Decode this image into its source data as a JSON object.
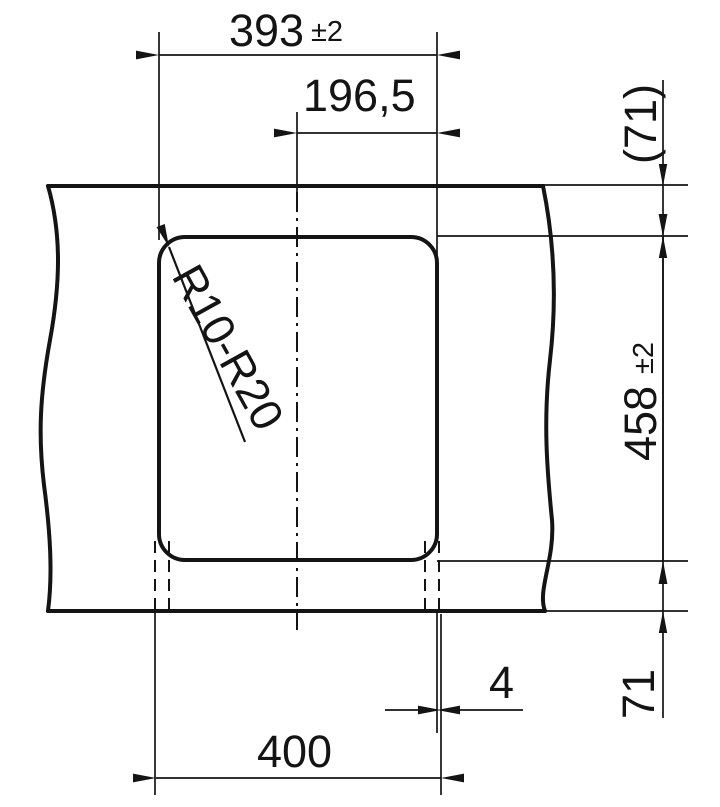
{
  "labels": {
    "cutout_width": "393",
    "cutout_width_tolerance": "±2",
    "centerline_offset": "196,5",
    "rear_distance": "(71)",
    "cutout_depth": "458",
    "cutout_depth_tolerance": "±2",
    "front_distance": "71",
    "edge_overlap": "4",
    "outer_width": "400",
    "corner_radius_range": "R10-R20"
  },
  "colors": {
    "line": "#141414",
    "background": "#ffffff"
  }
}
